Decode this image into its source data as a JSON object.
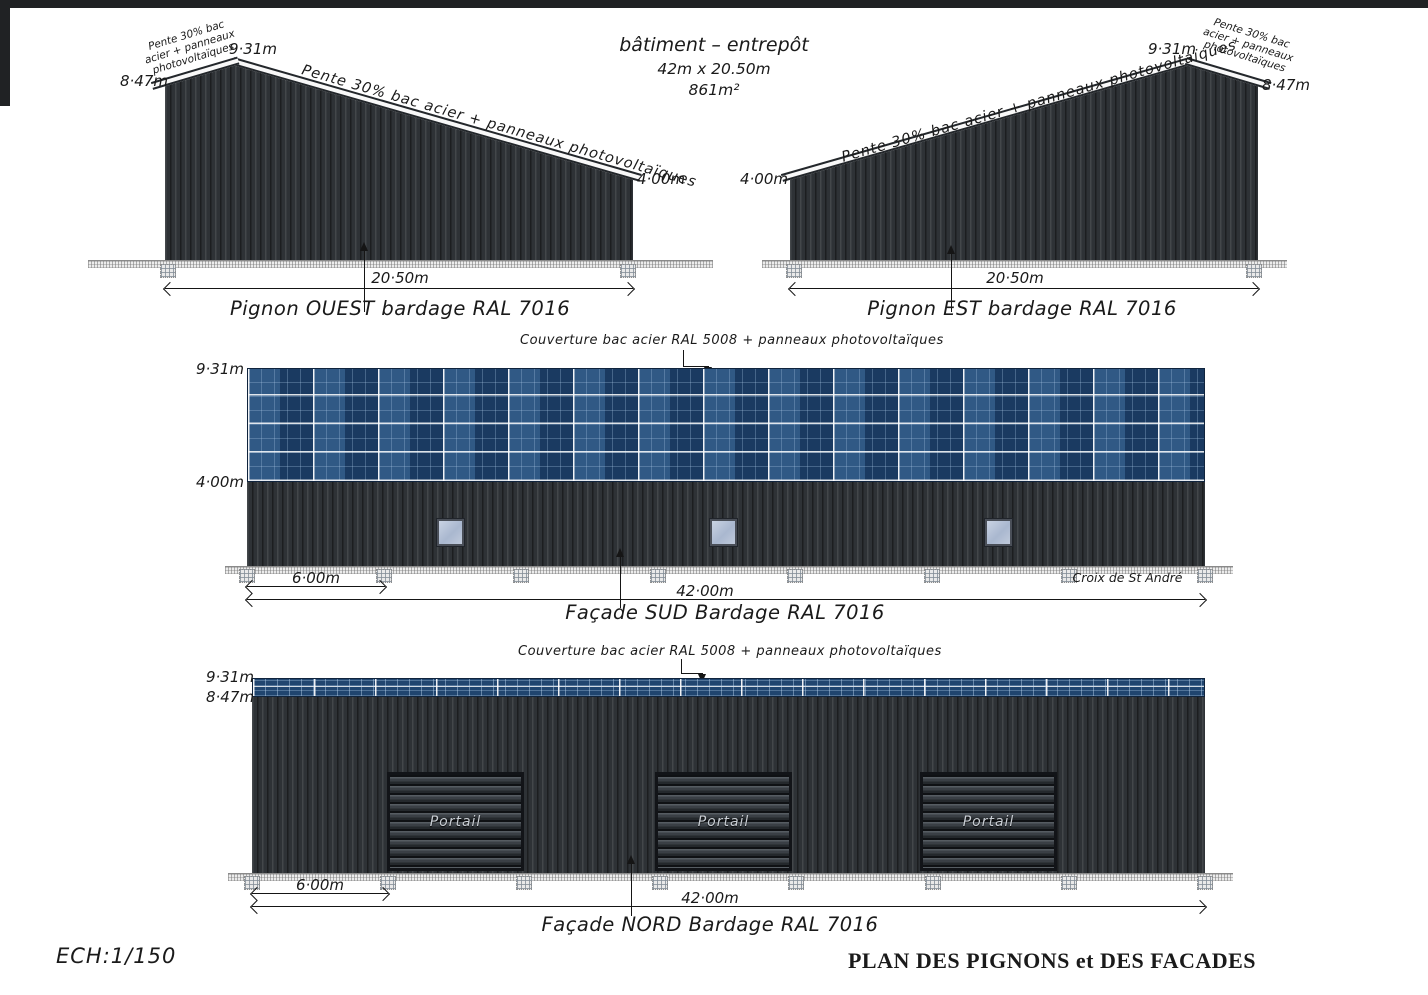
{
  "title_block": {
    "name": "bâtiment – entrepôt",
    "size": "42m x 20.50m",
    "area": "861m²"
  },
  "pignon_ouest": {
    "label": "Pignon OUEST bardage RAL 7016",
    "width_dim": "20·50m",
    "height_left": "8·47m",
    "height_peak": "9·31m",
    "height_right": "4·00m",
    "slope_note": "Pente 30% bac acier + panneaux photovoltaïques",
    "corner_note": [
      "Pente 30% bac",
      "acier + panneaux",
      "photovoltaïques"
    ]
  },
  "pignon_est": {
    "label": "Pignon EST bardage RAL 7016",
    "width_dim": "20·50m",
    "height_left": "4·00m",
    "height_peak": "9·31m",
    "height_right": "8·47m",
    "slope_note": "Pente 30% bac acier + panneaux photovoltaïques",
    "corner_note": [
      "Pente 30% bac",
      "acier + panneaux",
      "photovoltaïques"
    ]
  },
  "facade_sud": {
    "label": "Façade SUD Bardage RAL 7016",
    "roof_note": "Couverture bac acier RAL 5008 + panneaux photovoltaïques",
    "height_top": "9·31m",
    "height_panel_bottom": "4·00m",
    "bay_dim": "6·00m",
    "total_dim": "42·00m",
    "brace_note": "Croix de St André"
  },
  "facade_nord": {
    "label": "Façade NORD Bardage RAL 7016",
    "roof_note": "Couverture bac acier RAL 5008 + panneaux photovoltaïques",
    "height_top": "9·31m",
    "height_panel_bottom": "8·47m",
    "bay_dim": "6·00m",
    "total_dim": "42·00m",
    "door_label": "Portail"
  },
  "footer": {
    "scale": "ECH:1/150",
    "sheet_title": "PLAN DES PIGNONS et DES FACADES"
  },
  "colors": {
    "cladding_ral7016": "#2e3236",
    "panel_blue": "#20456f",
    "ink": "#1a1a1a"
  }
}
